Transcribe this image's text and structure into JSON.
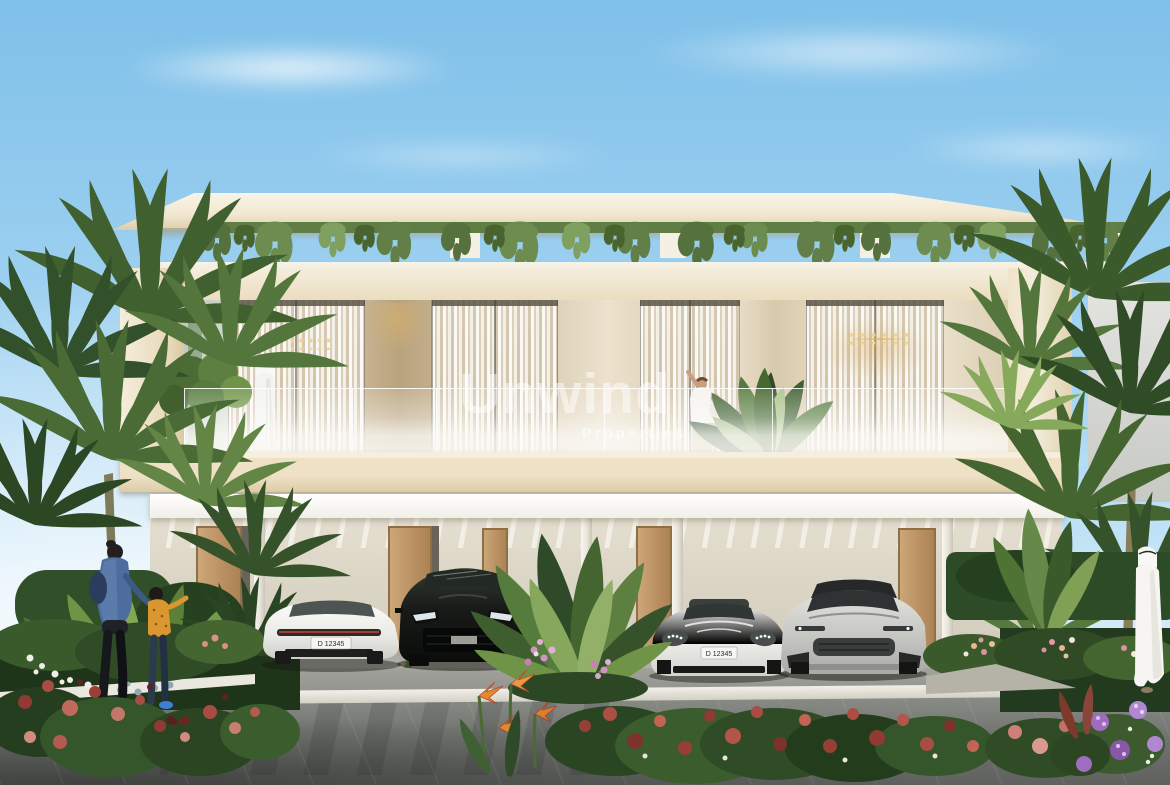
{
  "watermark": {
    "brand": "Unwind",
    "tagline": "Properties"
  },
  "vehicles": {
    "white_sedan_rear_plate": "D 12345",
    "white_sedan_front_plate": "D 12345"
  },
  "palette": {
    "sky_blue": "#8fc7ed",
    "facade_cream": "#f2ebd9",
    "interior_tan": "#c6b496",
    "foliage_green": "#4e6e38",
    "road_gray": "#6f716e"
  }
}
